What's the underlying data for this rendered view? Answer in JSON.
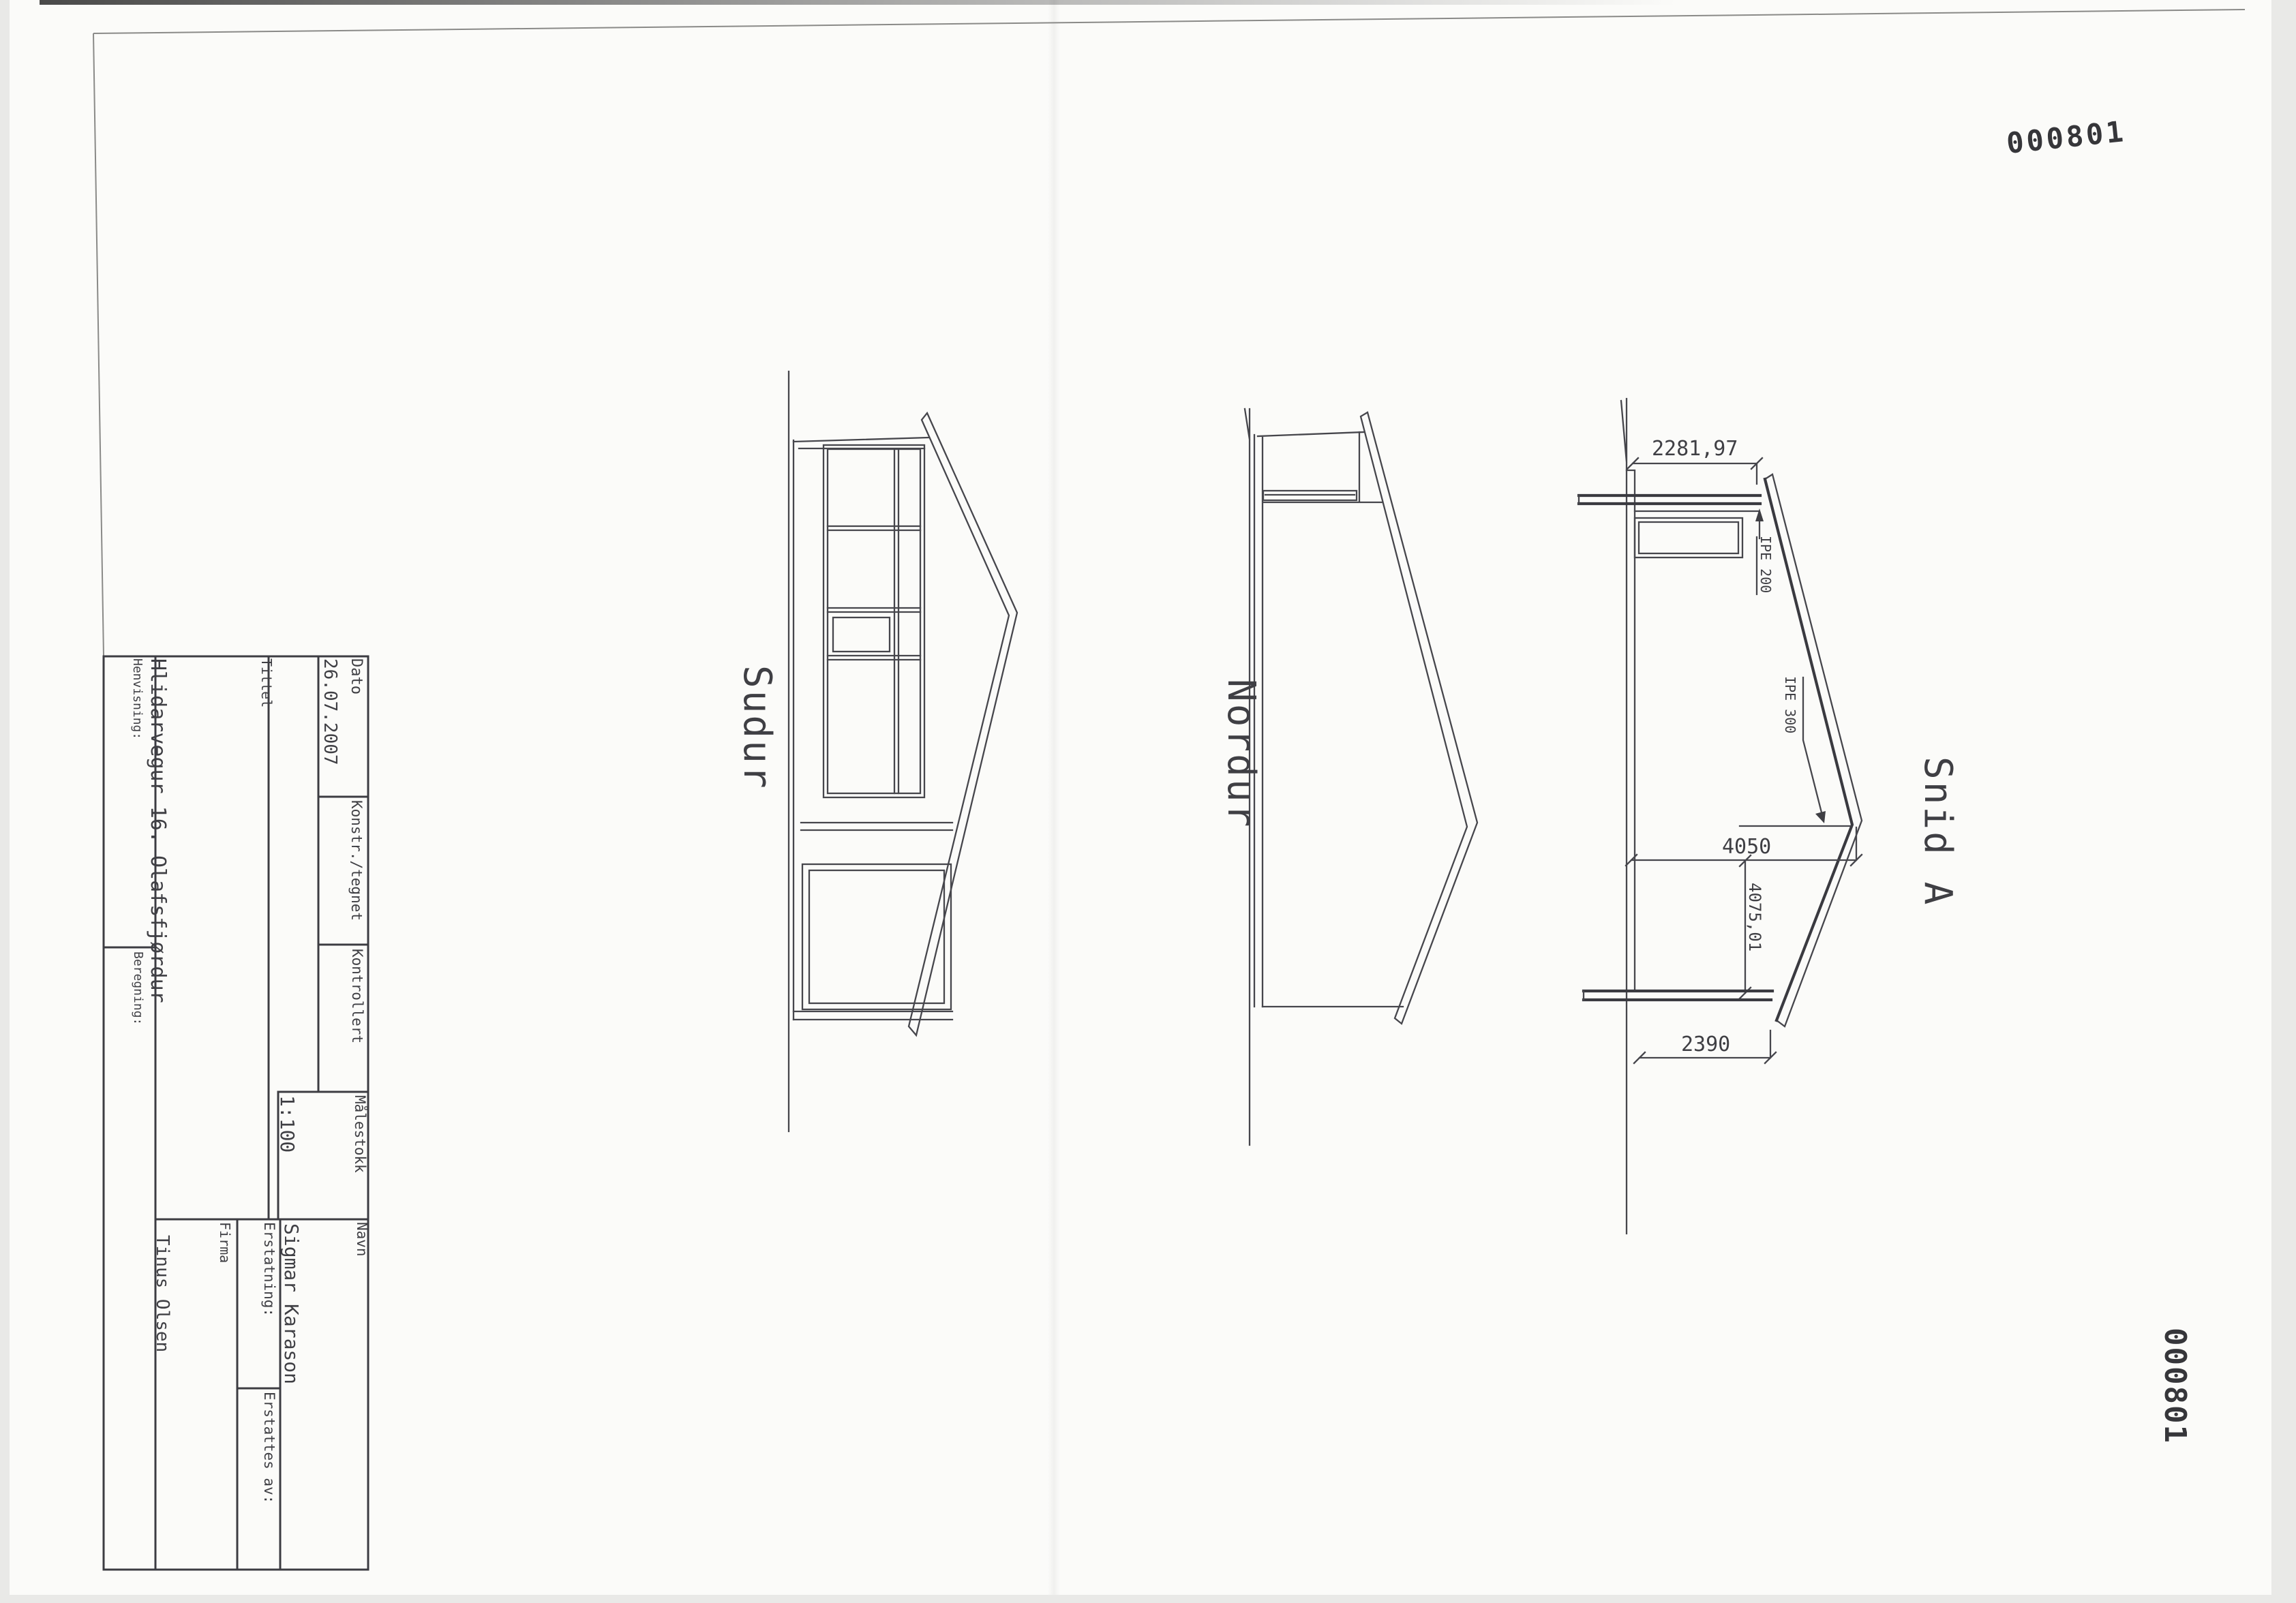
{
  "stamp": {
    "number": "000801"
  },
  "title_block": {
    "tittel_label": "Tittel",
    "tittel_value": "Hlidarvegur 16. Olafsfjørdur",
    "henvisning_label": "Henvisning:",
    "beregning_label": "Beregning:",
    "dato_label": "Dato",
    "dato_value": "26.07.2007",
    "konstr_label": "Konstr./tegnet",
    "kontrollert_label": "Kontrollert",
    "malestokk_label": "Målestokk",
    "malestokk_value": "1:100",
    "navn_label": "Navn",
    "navn_value": "Sigmar Karason",
    "erstatning_label": "Erstatning:",
    "erstattes_label": "Erstattes av:",
    "firma_label": "Firma",
    "firma_value": "Tinus Olsen"
  },
  "views": {
    "south_label": "Sudur",
    "north_label": "Nordur",
    "section_label": "Snid A"
  },
  "dimensions": {
    "top_width": "2281,97",
    "ridge_height": "4050",
    "span": "4075,01",
    "eave_height": "2390",
    "beam_top": "IPE 200",
    "beam_rafter": "IPE 300"
  }
}
